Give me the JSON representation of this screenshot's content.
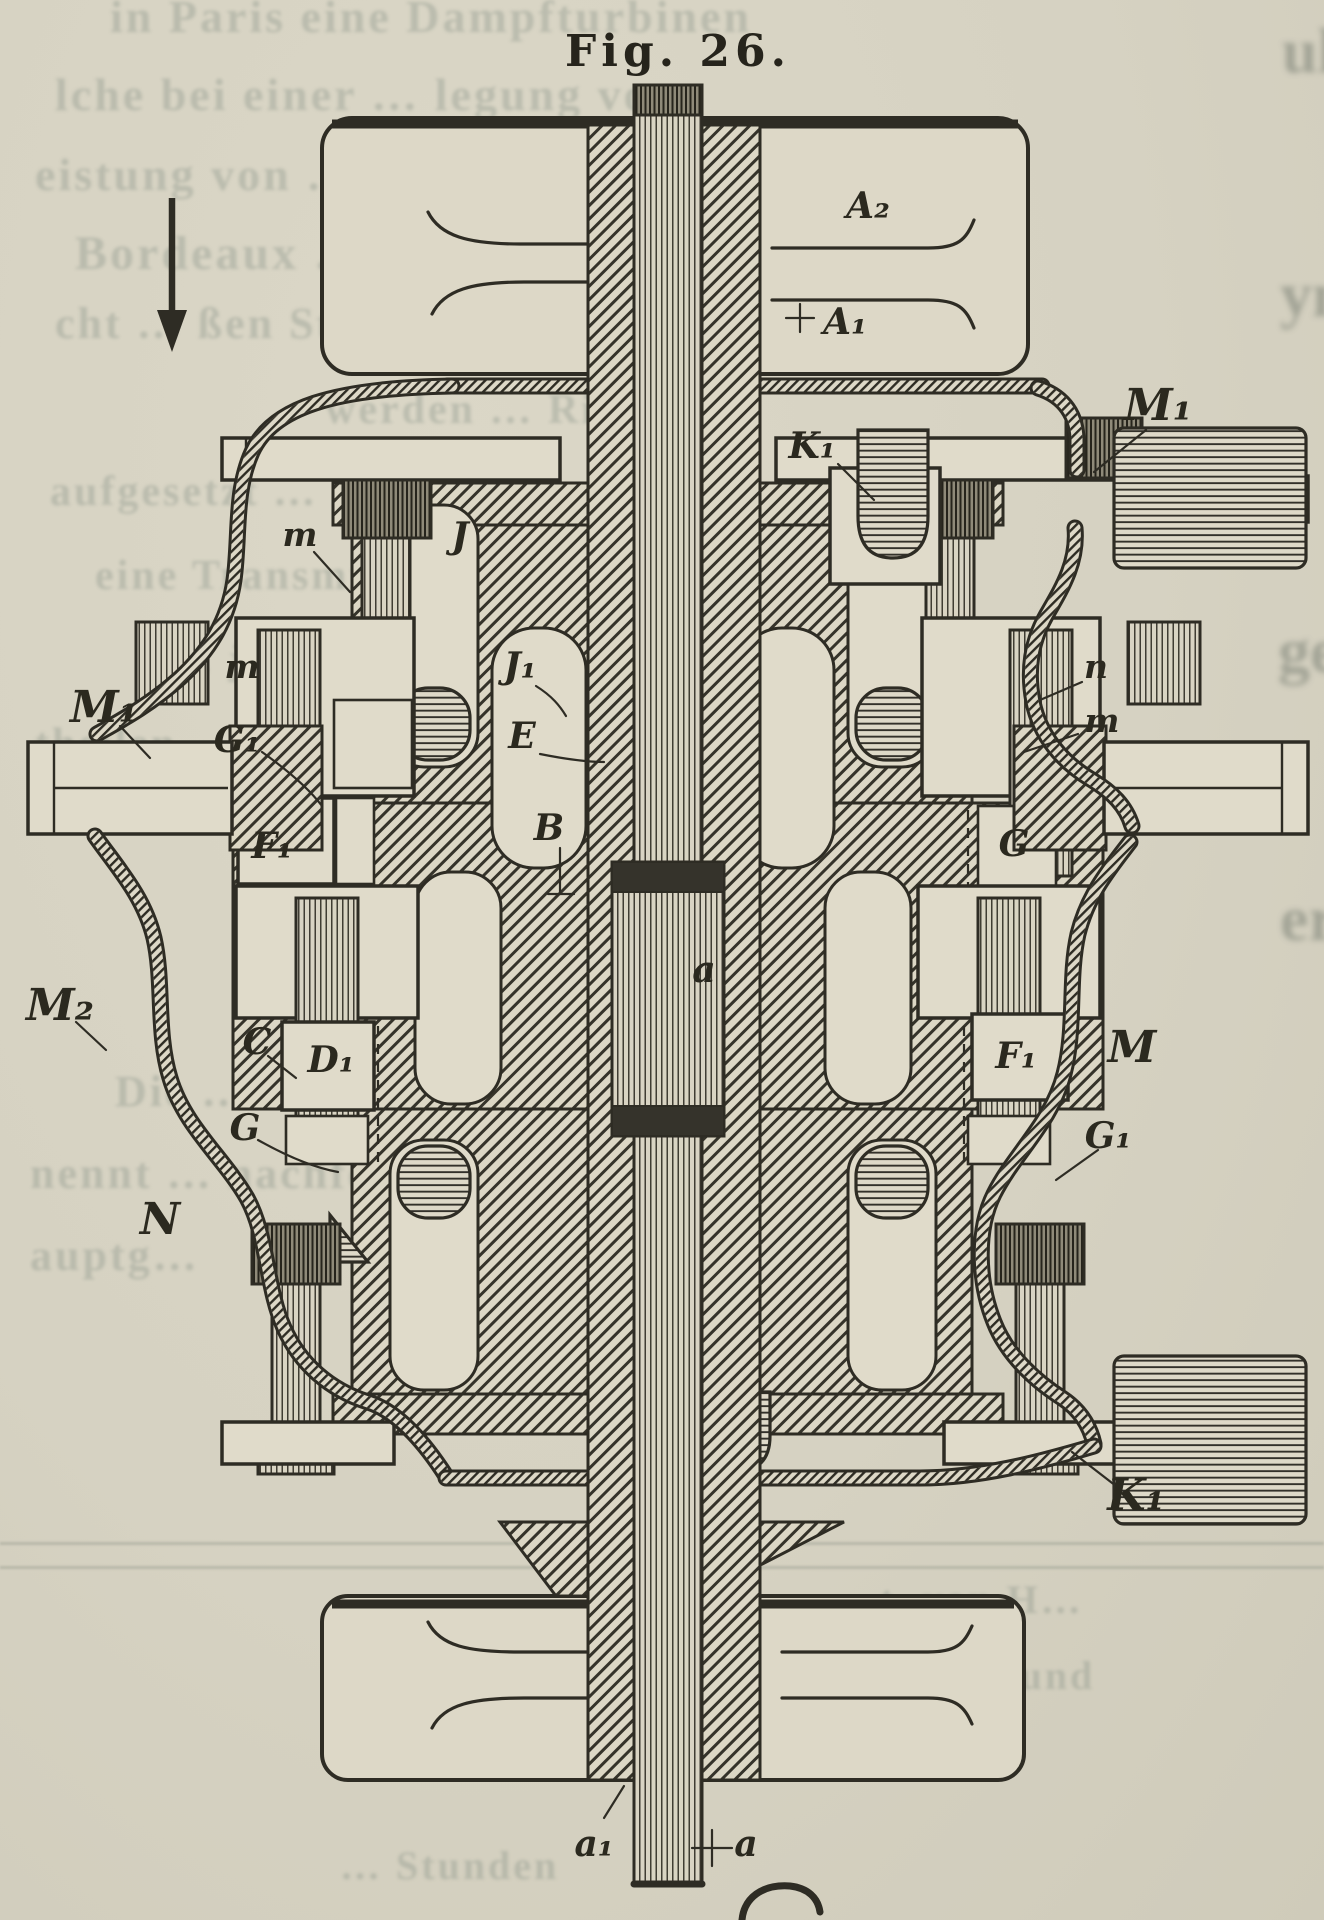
{
  "figure_title": "Fig. 26.",
  "colors": {
    "paper": "#d7d3c3",
    "ink": "#2e2c24",
    "ghost_text": "#76847c"
  },
  "labels": {
    "a2_top": "A₂",
    "a1_top": "A₁",
    "m1_top_right": "M₁",
    "k1_top_right": "K₁",
    "m_top_left": "m",
    "j_left": "J",
    "m_left": "m",
    "g1_left": "G₁",
    "m1_left": "M₁",
    "j1_center": "J₁",
    "e_center": "E",
    "b_center": "B",
    "f1_left": "F₁",
    "a_hub": "a",
    "n_right": "n",
    "m_right": "m",
    "g_right": "G",
    "m2_left": "M₂",
    "c_left": "C",
    "d1_left": "D₁",
    "g_left": "G",
    "n_left_big": "N",
    "f1_right": "F₁",
    "m_right_cap": "M",
    "g1_right": "G₁",
    "k1_bottom_right": "K₁",
    "a1_bottom": "a₁",
    "a_bottom": "a"
  },
  "ghost_text": {
    "l1": "in Paris eine Dampfturbinen",
    "l2": "lche bei einer … legung von",
    "l3": "eistung von … erstellt und s",
    "l4": "Bordeaux … treiben von Dyn",
    "l5": "cht … ßen Stücke.",
    "l6": "werden … Riemen",
    "l7": "aufgesetzt … kommen.",
    "l8": "eine Transmission … von",
    "l9": "… jeder Maschine gek…",
    "l10": "theilen …",
    "l11": "Die … und 2 …",
    "l12": "nennt … nachfolg…",
    "l13": "auptg…",
    "l14": "t. von H…",
    "l15": "auf 9 … und",
    "l16": "… Stunden",
    "edge1": "ul",
    "edge2": "yn",
    "edge3": "ge",
    "edge4": "er"
  }
}
